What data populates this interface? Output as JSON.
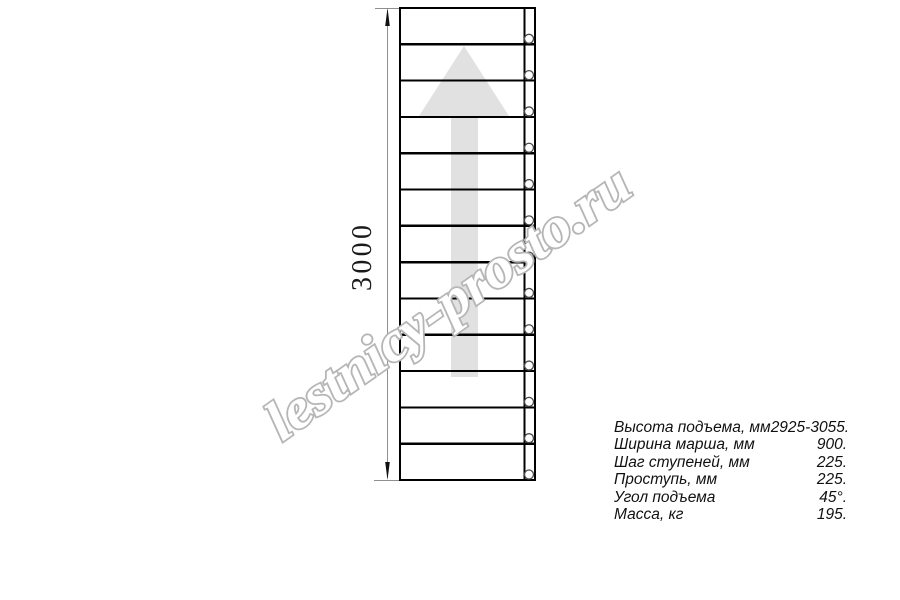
{
  "watermark": {
    "text": "lestnicy-prosto.ru",
    "outline_color": "#b6b6b6",
    "fill_color": "#ffffff"
  },
  "drawing": {
    "dimension_label": "3000",
    "steps": 13,
    "colors": {
      "line": "#000000",
      "dimension_line": "#8f8f8f",
      "dimension_arrow": "#111111",
      "direction_arrow_fill": "#e1e1e1",
      "bolt_circle_stroke": "#4a4a4a"
    }
  },
  "specs": {
    "rows": [
      {
        "label": "Высота подъема, мм",
        "value": "2925-3055."
      },
      {
        "label": "Ширина марша, мм",
        "value": "900."
      },
      {
        "label": "Шаг ступеней, мм",
        "value": "225."
      },
      {
        "label": "Проступь, мм",
        "value": "225."
      },
      {
        "label": "Угол подъема",
        "value": "45°."
      },
      {
        "label": "Масса, кг",
        "value": "195."
      }
    ]
  }
}
